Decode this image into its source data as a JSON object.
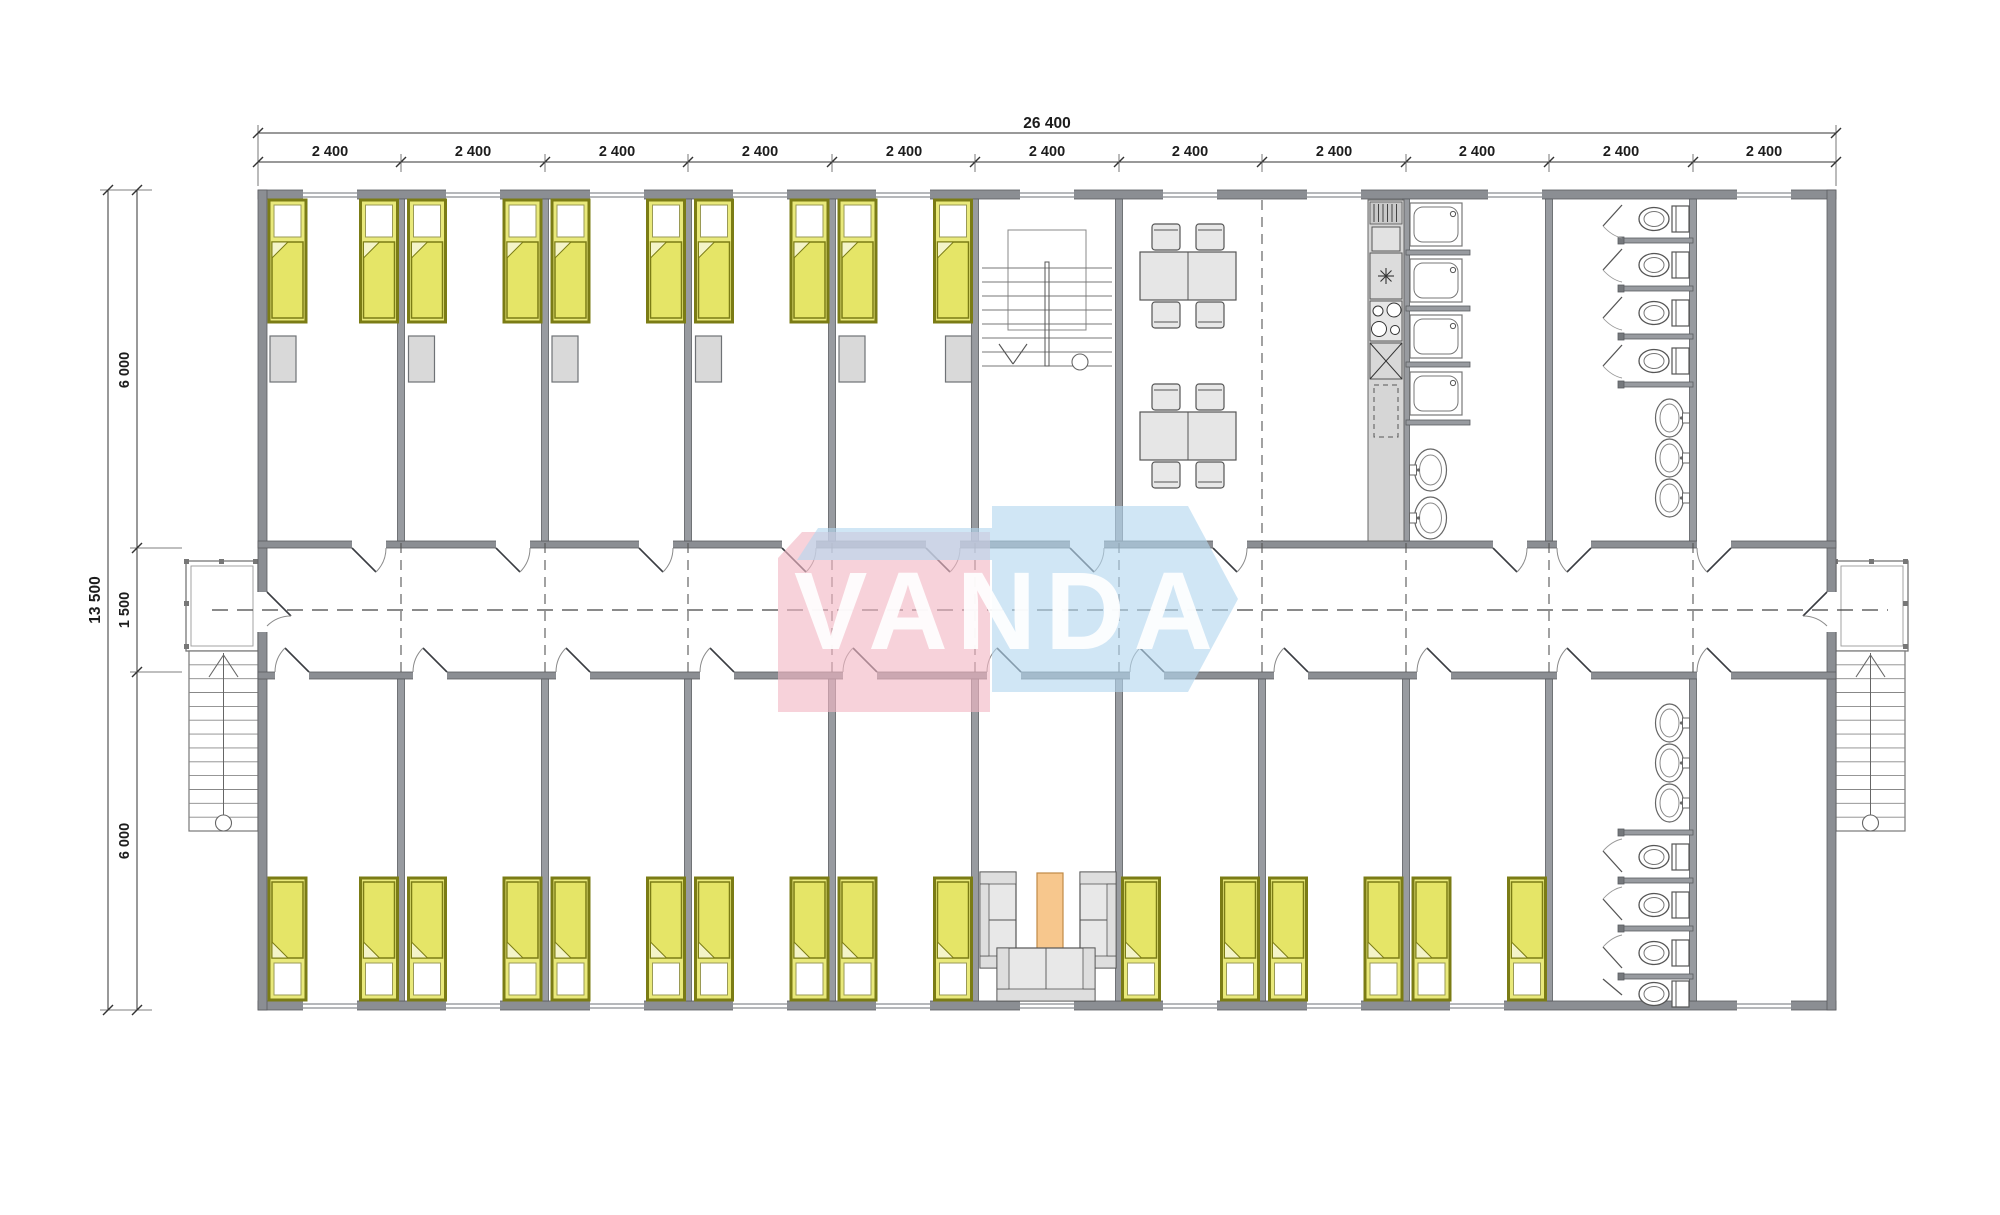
{
  "plan": {
    "logo_text": "VANDA",
    "dim_total_width": "26 400",
    "dim_bays": [
      "2 400",
      "2 400",
      "2 400",
      "2 400",
      "2 400",
      "2 400",
      "2 400",
      "2 400",
      "2 400",
      "2 400",
      "2 400"
    ],
    "dim_total_height": "13 500",
    "dim_height_segments": [
      "6 000",
      "1 500",
      "6 000"
    ]
  },
  "legend": {
    "elements": [
      "bed",
      "wardrobe",
      "dining-table",
      "chair",
      "kitchen-counter",
      "cooktop",
      "sink",
      "shower-cubicle",
      "toilet",
      "wash-basin",
      "sofa",
      "armchair",
      "coffee-table",
      "staircase",
      "landing",
      "corridor-centerline",
      "window",
      "door"
    ]
  },
  "colors": {
    "wall": "#8b8e93",
    "bed_fill": "#e9e97b",
    "bed_border": "#7b7c15",
    "furniture_fill": "#e8e8e8",
    "coffee_table": "#f7c78d",
    "logo_pink": "#f2b6c3",
    "logo_blue": "#b3d7ef"
  }
}
